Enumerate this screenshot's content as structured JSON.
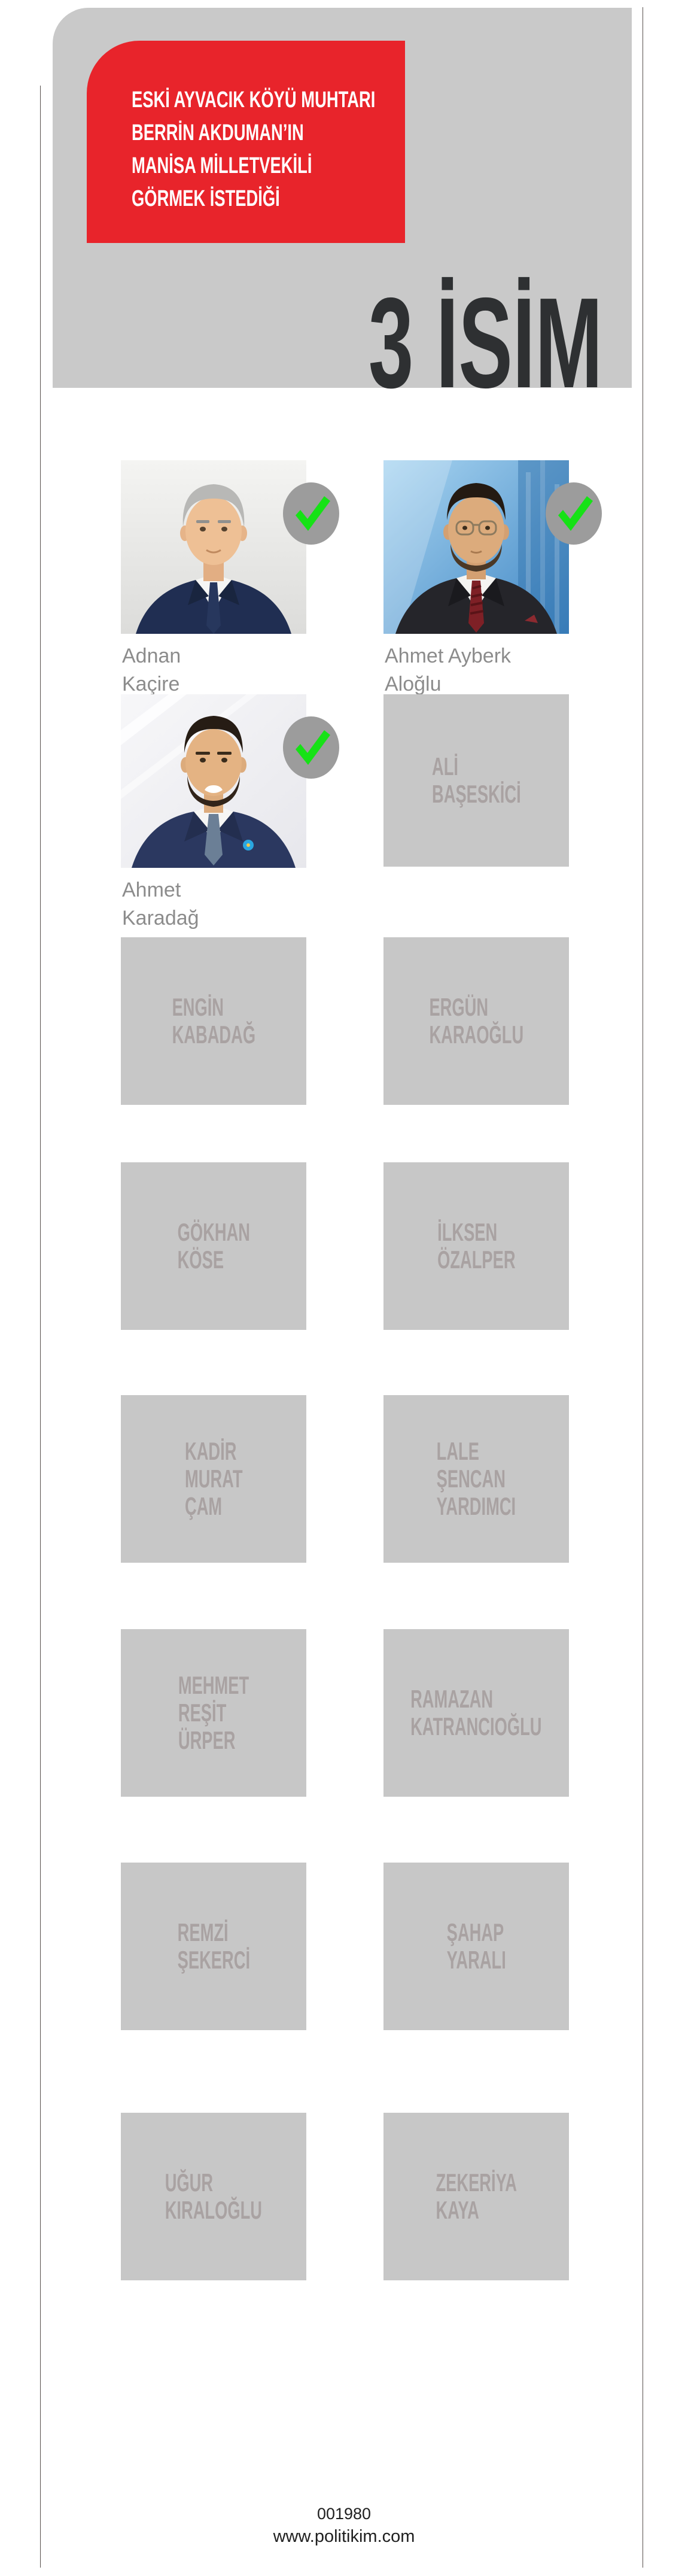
{
  "header": {
    "red_box_lines": [
      "ESKİ AYVACIK KÖYÜ MUHTARI",
      "BERRİN AKDUMAN’IN",
      "MANİSA MİLLETVEKİLİ",
      "GÖRMEK İSTEDİĞİ"
    ],
    "big_title": "3 İSİM"
  },
  "grid": {
    "cells": [
      {
        "type": "photo",
        "caption_lines": [
          "Adnan",
          "Kaçire"
        ],
        "checked": true,
        "photo_style": "gray-studio"
      },
      {
        "type": "photo",
        "caption_lines": [
          "Ahmet Ayberk",
          "Aloğlu"
        ],
        "checked": true,
        "photo_style": "blue-city"
      },
      {
        "type": "photo",
        "caption_lines": [
          "Ahmet",
          "Karadağ"
        ],
        "checked": true,
        "photo_style": "light-studio"
      },
      {
        "type": "name-box",
        "lines": [
          "ALİ",
          "BAŞESKİCİ"
        ]
      },
      {
        "type": "name-box",
        "lines": [
          "ENGİN",
          "KABADAĞ"
        ]
      },
      {
        "type": "name-box",
        "lines": [
          "ERGÜN",
          "KARAOĞLU"
        ]
      },
      {
        "type": "name-box",
        "lines": [
          "GÖKHAN",
          "KÖSE"
        ]
      },
      {
        "type": "name-box",
        "lines": [
          "İLKSEN",
          "ÖZALPER"
        ]
      },
      {
        "type": "name-box",
        "lines": [
          "KADİR",
          "MURAT",
          "ÇAM"
        ]
      },
      {
        "type": "name-box",
        "lines": [
          "LALE",
          "ŞENCAN",
          "YARDIMCI"
        ]
      },
      {
        "type": "name-box",
        "lines": [
          "MEHMET",
          "REŞİT",
          "ÜRPER"
        ]
      },
      {
        "type": "name-box",
        "lines": [
          "RAMAZAN",
          "KATRANCIOĞLU"
        ]
      },
      {
        "type": "name-box",
        "lines": [
          "REMZİ",
          "ŞEKERCİ"
        ]
      },
      {
        "type": "name-box",
        "lines": [
          "ŞAHAP",
          "YARALI"
        ]
      },
      {
        "type": "name-box",
        "lines": [
          "UĞUR",
          "KIRALOĞLU"
        ]
      },
      {
        "type": "name-box",
        "lines": [
          "ZEKERİYA",
          "KAYA"
        ]
      }
    ]
  },
  "icons": {
    "check_badge": "green-check-on-gray-ellipse"
  },
  "colors": {
    "header_panel": "#c9c9c9",
    "red_box": "#e8242b",
    "title_text": "#2e3032",
    "name_box": "#c7c7c7",
    "name_box_text": "#a9a2a2",
    "caption_text": "#8c8c8c",
    "badge_gray": "#9c9c9c",
    "check_green": "#16e216",
    "frame_line": "#57504d",
    "footer_text": "#1f1f1f"
  },
  "footer": {
    "code": "001980",
    "site": "www.politikim.com"
  }
}
